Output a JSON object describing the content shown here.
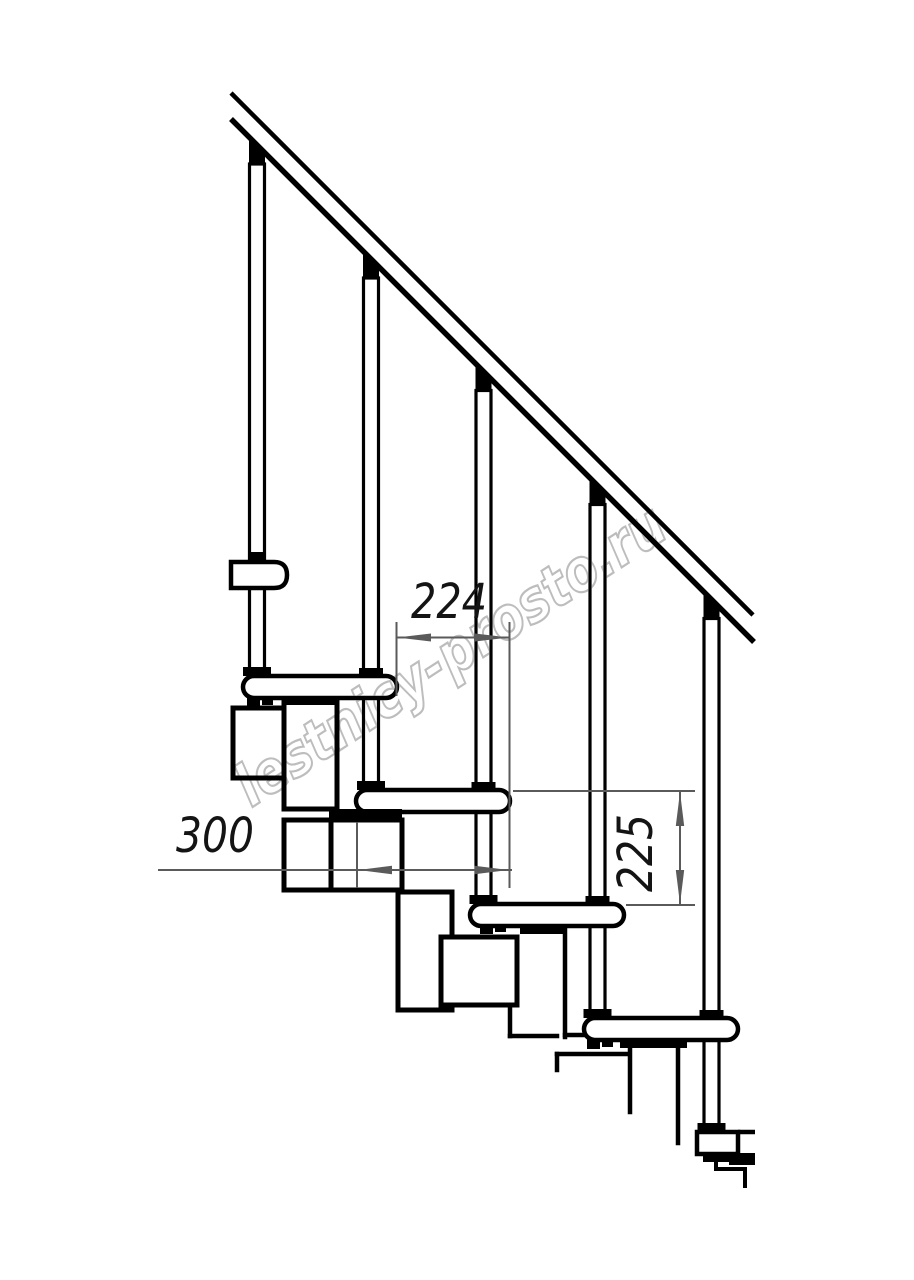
{
  "drawing": {
    "dimensions": {
      "going": {
        "label": "224"
      },
      "tread_depth": {
        "label": "300"
      },
      "rise": {
        "label": "225"
      }
    },
    "watermark": {
      "text": "lestnicy-prosto.ru",
      "color": "#b8b8b8"
    },
    "colors": {
      "line": "#000000",
      "dimension": "#5a5a5a",
      "label": "#141414",
      "background": "#ffffff"
    }
  }
}
